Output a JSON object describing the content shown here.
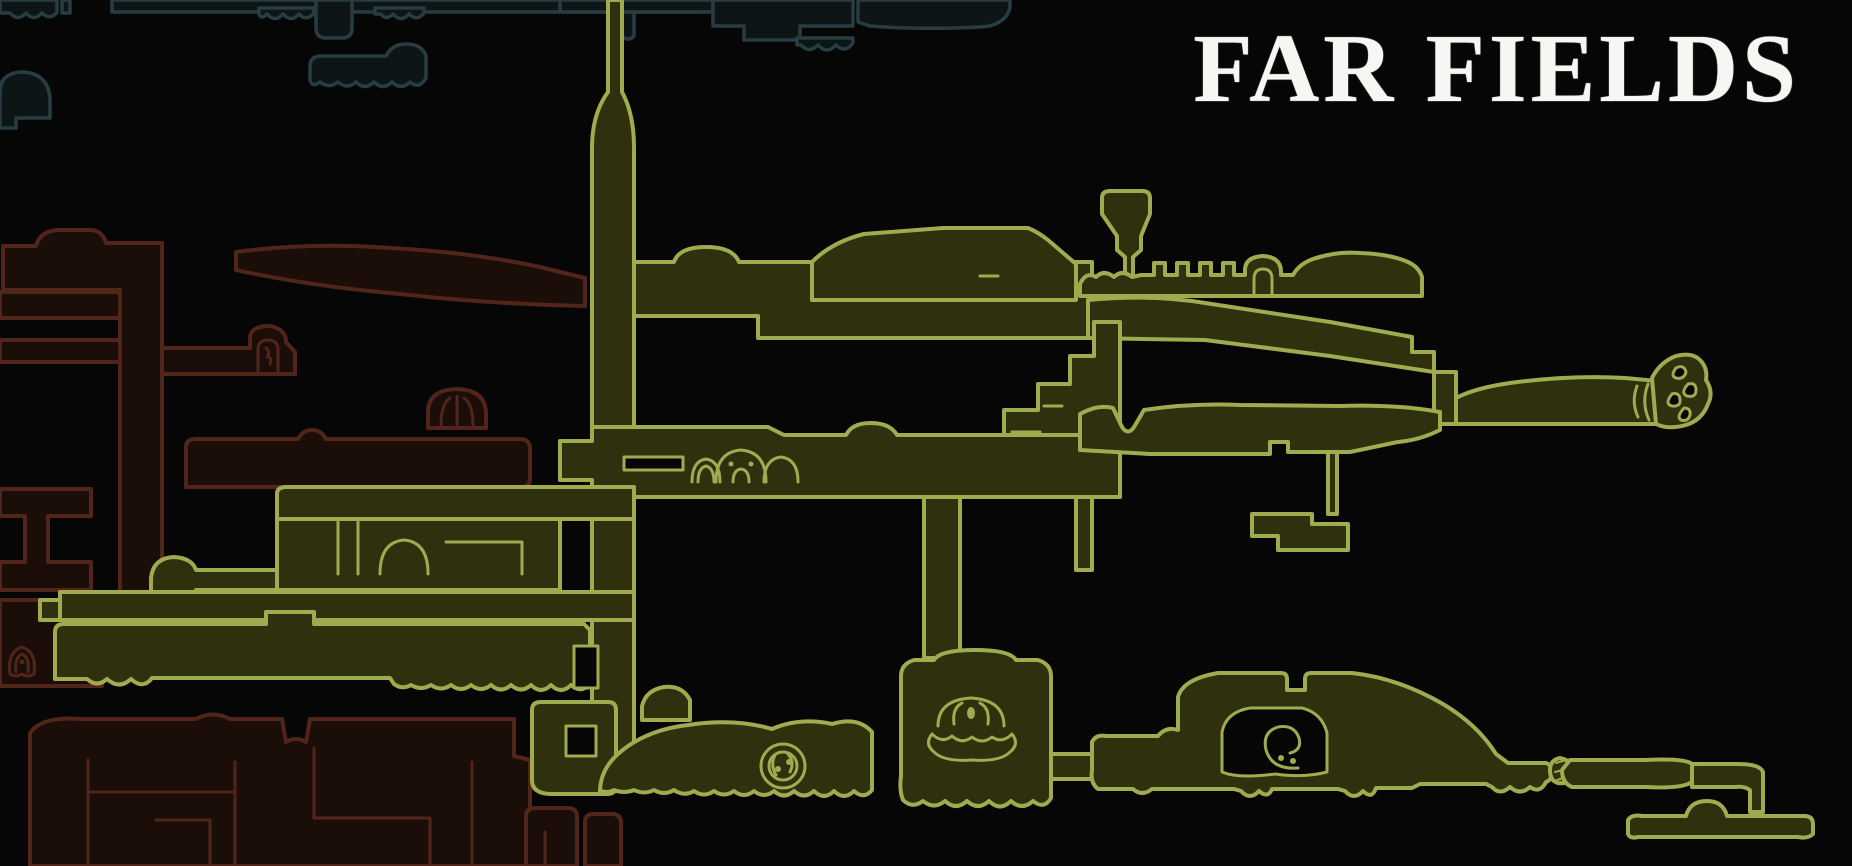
{
  "title": "FAR FIELDS",
  "map": {
    "background": "#060607",
    "title_color": "#f6f6f3",
    "regions": {
      "far_fields": {
        "name": "Far Fields",
        "fill": "#2e300e",
        "stroke": "#a0aa4e"
      },
      "west_region": {
        "name": "adjacent western region (dimmed)",
        "fill": "#1b0d08",
        "stroke": "#51251a"
      },
      "north_region": {
        "name": "adjacent northern region (dimmed)",
        "fill": "#0d1517",
        "stroke": "#263d42"
      }
    },
    "landmarks": [
      {
        "icon": "clam-shell-icon"
      },
      {
        "icon": "spiral-wheel-icon"
      },
      {
        "icon": "caterpillar-bumps-icon"
      },
      {
        "icon": "curled-creature-icon"
      },
      {
        "icon": "arch-cave-icon"
      },
      {
        "icon": "ribbed-dome-icon"
      },
      {
        "icon": "small-bell-icon"
      },
      {
        "icon": "ornate-root-tip-icon"
      },
      {
        "icon": "hollow-log-icon"
      }
    ]
  }
}
